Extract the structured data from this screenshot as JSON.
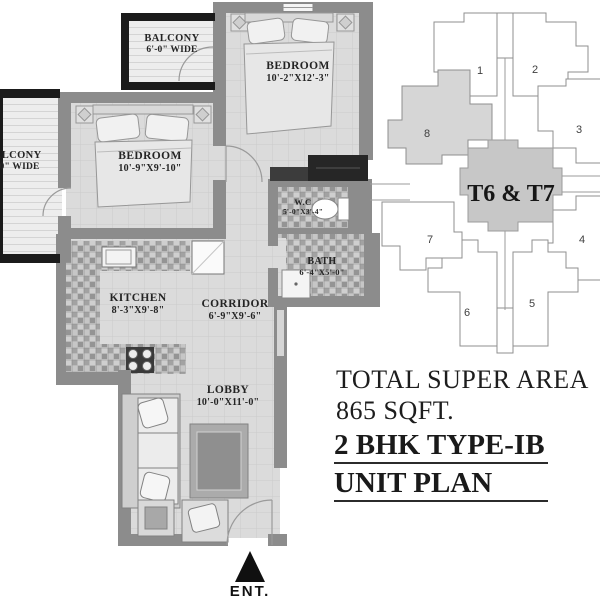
{
  "plan_title": {
    "line1": "2 BHK TYPE-IB",
    "line2": "UNIT PLAN"
  },
  "super_area": {
    "line1": "TOTAL SUPER AREA",
    "line2": "865 SQFT."
  },
  "entrance_label": "ENT.",
  "rooms": [
    {
      "name": "BALCONY",
      "dims": "6'-0\" WIDE"
    },
    {
      "name": "BEDROOM",
      "dims": "10'-2\"X12'-3\""
    },
    {
      "name": "BALCONY",
      "dims": "6'-0\" WIDE"
    },
    {
      "name": "BEDROOM",
      "dims": "10'-9\"X9'-10\""
    },
    {
      "name": "W.C",
      "dims": "5'-0\"X3'-4\""
    },
    {
      "name": "BATH",
      "dims": "6'-4\"X5'-0\""
    },
    {
      "name": "KITCHEN",
      "dims": "8'-3\"X9'-8\""
    },
    {
      "name": "CORRIDOR",
      "dims": "6'-9\"X9'-6\""
    },
    {
      "name": "LOBBY",
      "dims": "10'-0\"X11'-0\""
    }
  ],
  "keyplan": {
    "center_label": "T6 & T7",
    "units": [
      "1",
      "2",
      "3",
      "4",
      "5",
      "6",
      "7",
      "8"
    ],
    "highlighted_unit": "8"
  },
  "colors": {
    "wall": "#8c8c8c",
    "balcony_frame": "#1b1b1b",
    "keyplan_center_fill": "#c7c7c7",
    "keyplan_highlight_fill": "#d6d6d6",
    "text": "#1d1d1d"
  }
}
